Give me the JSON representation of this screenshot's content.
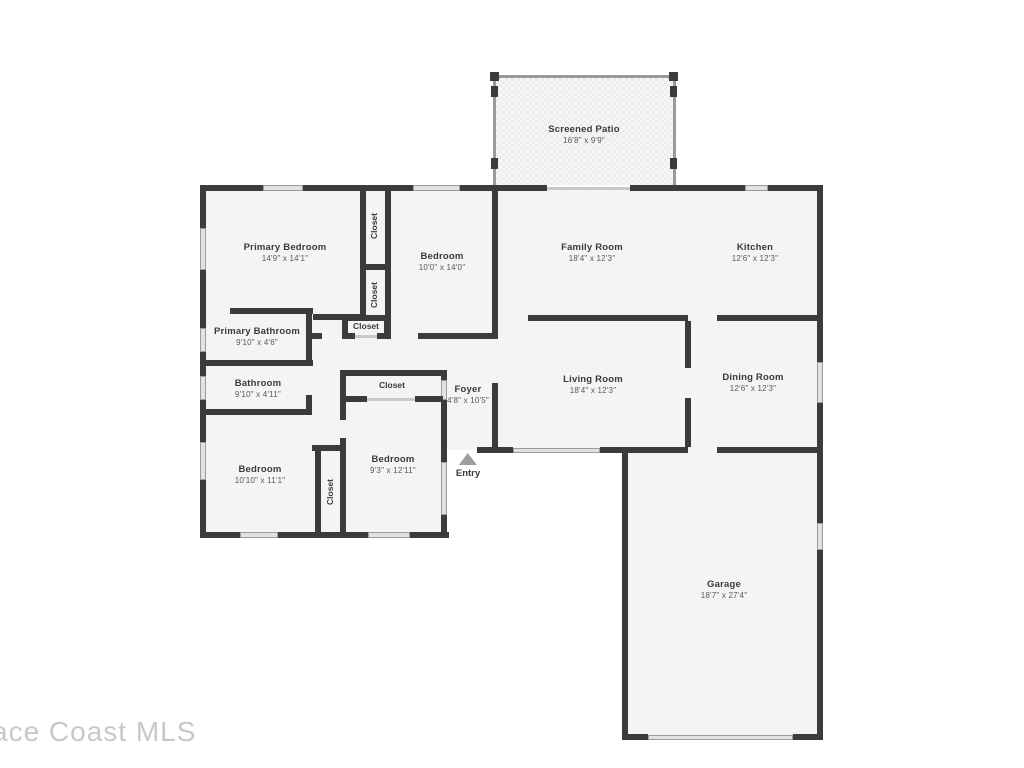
{
  "watermark": "ace Coast MLS",
  "entry": {
    "label": "Entry"
  },
  "rooms": [
    {
      "id": "screened-patio",
      "label": "Screened Patio",
      "dims": "16'8\" x 9'9\""
    },
    {
      "id": "primary-bedroom",
      "label": "Primary Bedroom",
      "dims": "14'9\" x 14'1\""
    },
    {
      "id": "bedroom-top",
      "label": "Bedroom",
      "dims": "10'0\" x 14'0\""
    },
    {
      "id": "family-room",
      "label": "Family Room",
      "dims": "18'4\" x 12'3\""
    },
    {
      "id": "kitchen",
      "label": "Kitchen",
      "dims": "12'6\" x 12'3\""
    },
    {
      "id": "primary-bathroom",
      "label": "Primary Bathroom",
      "dims": "9'10\" x 4'6\""
    },
    {
      "id": "bathroom",
      "label": "Bathroom",
      "dims": "9'10\" x 4'11\""
    },
    {
      "id": "living-room",
      "label": "Living Room",
      "dims": "18'4\" x 12'3\""
    },
    {
      "id": "dining-room",
      "label": "Dining Room",
      "dims": "12'6\" x 12'3\""
    },
    {
      "id": "foyer",
      "label": "Foyer",
      "dims": "4'8\" x 10'5\""
    },
    {
      "id": "bedroom-bottom-left",
      "label": "Bedroom",
      "dims": "10'10\" x 11'1\""
    },
    {
      "id": "bedroom-bottom-middle",
      "label": "Bedroom",
      "dims": "9'3\" x 12'11\""
    },
    {
      "id": "garage",
      "label": "Garage",
      "dims": "18'7\" x 27'4\""
    }
  ],
  "closets": [
    {
      "id": "closet-strip-upper",
      "label": "Closet"
    },
    {
      "id": "closet-strip-lower",
      "label": "Closet"
    },
    {
      "id": "closet-hall",
      "label": "Closet"
    },
    {
      "id": "closet-bedroom",
      "label": "Closet"
    },
    {
      "id": "closet-between-bedrooms",
      "label": "Closet"
    }
  ],
  "colors": {
    "wall": "#3b3b3b",
    "room_fill": "#f4f4f4",
    "window_fill": "#e2e2e2",
    "watermark": "#c8c8c8"
  }
}
